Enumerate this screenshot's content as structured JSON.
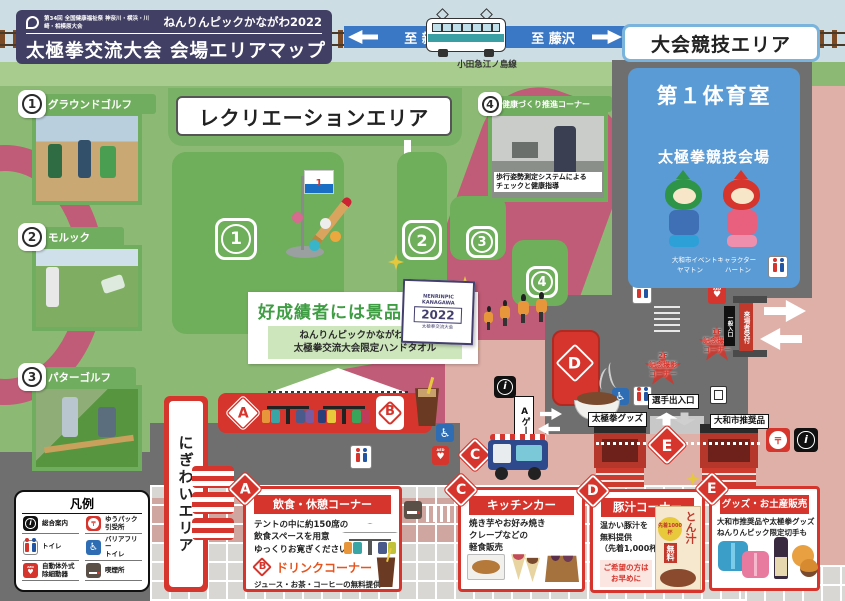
{
  "header": {
    "event_no": "第34回 全国健康福祉祭 神奈川・横浜・川崎・相模原大会",
    "brand": "ねんりんピックかながわ2022",
    "title": "太極拳交流大会 会場エリアマップ"
  },
  "railway": {
    "to_left": "至 新宿",
    "to_right": "至 藤沢",
    "line": "小田急江ノ島線"
  },
  "competition": {
    "area": "大会競技エリア",
    "hall": "第１体育室",
    "venue": "太極拳競技会場",
    "mascot_caption": "大和市イベントキャラクター",
    "mascot_left": "ヤマトン",
    "mascot_right": "ハートン"
  },
  "recreation": {
    "title": "レクリエーションエリア",
    "flag": "1",
    "spots": [
      "1",
      "2",
      "3",
      "4"
    ]
  },
  "photos": [
    {
      "num": "1",
      "label": "グラウンドゴルフ"
    },
    {
      "num": "2",
      "label": "モルック"
    },
    {
      "num": "3",
      "label": "パターゴルフ"
    },
    {
      "num": "4",
      "label": "健康づくり推進コーナー",
      "caption": "歩行姿勢測定システムによる\nチェックと健康指導"
    }
  ],
  "prize": {
    "headline": "好成績者には景品も",
    "sub": "ねんりんピックかながわ2022\n太極拳交流大会限定ハンドタオル",
    "towel_logo": "NENRINPIC\nKANAGAWA",
    "towel_year": "2022",
    "towel_caption": "太極拳交流大会"
  },
  "legend": {
    "title": "凡例",
    "items": [
      {
        "label": "総合案内"
      },
      {
        "label": "ゆうパック\n引受所"
      },
      {
        "label": "トイレ"
      },
      {
        "label": "バリアフリー\nトイレ"
      },
      {
        "label": "自動体外式\n除細動器"
      },
      {
        "label": "喫煙所"
      }
    ]
  },
  "areas": {
    "nigiwai": "にぎわいエリア"
  },
  "marks": {
    "a": "A",
    "b": "B",
    "c": "C",
    "d": "D",
    "e": "E"
  },
  "labels": {
    "a_gate": "Aゲート",
    "players_gate": "選手出入口",
    "taichi_goods": "太極拳グッズ",
    "yamato_goods": "大和市推奨品",
    "photo_1f": "1F\n記念撮影\nコーナー",
    "photo_2f": "2F\n記念撮影\nコーナー",
    "entrance_side": "一般入口",
    "reception": "来場者受付"
  },
  "booths": {
    "a": {
      "title": "飲食・休憩コーナー",
      "body": "テントの中に約150席の\n飲食スペースを用意\nゆっくりお寛ぎください",
      "drink_title": "ドリンクコーナー",
      "drink_body": "ジュース・お茶・コーヒーの無料提供"
    },
    "c": {
      "title": "キッチンカー",
      "body": "焼き芋やお好み焼き\nクレープなどの\n軽食販売"
    },
    "d": {
      "title": "豚汁コーナー",
      "body": "温かい豚汁を\n無料提供\n（先着1,000杯）",
      "note": "ご希望の方は\nお早めに",
      "poster_product": "とん汁",
      "poster_count": "先着1000杯",
      "poster_free": "無料"
    },
    "e": {
      "title": "グッズ・お土産販売",
      "body": "大和市推奨品や太極拳グッズ\nねんりんピック限定切手も"
    }
  },
  "icons": {
    "info": "i",
    "yupack": "〒",
    "heart": "♥",
    "aed": "AED",
    "wheelchair": "♿"
  },
  "colors": {
    "red": "#d5352c",
    "green": "#8cba74",
    "blue": "#5b9bd5",
    "salmon": "#dfb0a8",
    "navy": "#413f63"
  }
}
